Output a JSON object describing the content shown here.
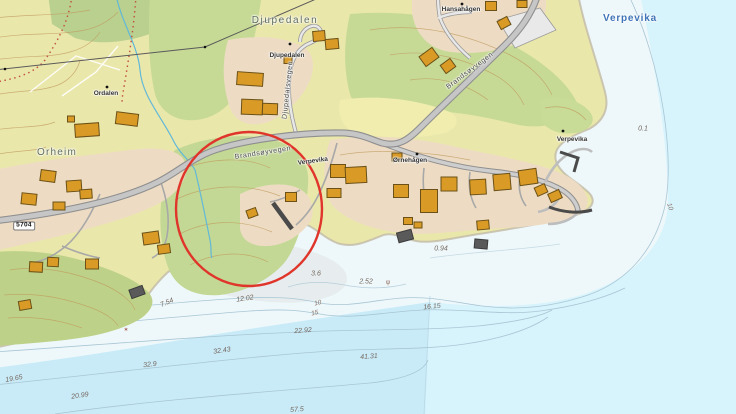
{
  "map": {
    "description": "Topographic coastal map with nautical depth soundings and a red circle annotation",
    "place_labels": [
      {
        "text": "Djupedalen"
      },
      {
        "text": "Djupedalen"
      },
      {
        "text": "Hansahågen"
      },
      {
        "text": "Verpevika"
      },
      {
        "text": "Ordalen"
      },
      {
        "text": "Orheim"
      },
      {
        "text": "Verpevika"
      },
      {
        "text": "Ørnehågen"
      },
      {
        "text": "Verpevika"
      }
    ],
    "road_labels": [
      {
        "text": "Brandsøyvegen"
      },
      {
        "text": "Brandsøyvegen"
      },
      {
        "text": "Djupedalsvegen"
      }
    ],
    "road_number": "5704",
    "soundings": [
      {
        "value": "0.1"
      },
      {
        "value": "0.94"
      },
      {
        "value": "3.6"
      },
      {
        "value": "2.52"
      },
      {
        "value": "12.02"
      },
      {
        "value": "16.15"
      },
      {
        "value": "22.92"
      },
      {
        "value": "32.43"
      },
      {
        "value": "32.9"
      },
      {
        "value": "41.31"
      },
      {
        "value": "7.54"
      },
      {
        "value": "19.65"
      },
      {
        "value": "20.99"
      },
      {
        "value": "57.5"
      }
    ],
    "depth_contour_labels": [
      {
        "value": "10"
      },
      {
        "value": "15"
      },
      {
        "value": "10"
      }
    ],
    "symbols": [
      {
        "name": "kelp-symbol",
        "glyph": "ψ"
      },
      {
        "name": "rock-awash-symbol",
        "glyph": "✶"
      }
    ],
    "annotation": {
      "shape": "ellipse",
      "purpose": "highlight area",
      "color": "#e0352b"
    }
  },
  "colors": {
    "sea": "#d7f3fc",
    "sea_deep": "#c9ebf8",
    "sea_shallow": "#eef8fb",
    "land_open": "#eae7ab",
    "vegetation": "#c6da96",
    "residential": "#eddcc3",
    "building": "#d99a26",
    "building_outline": "#6b5117",
    "road_fill": "#c6c6c6",
    "road_casing": "#8f8f8f",
    "land_contour": "#c09a5f",
    "depth_contour": "#a9c6d4",
    "stream": "#62b8d8",
    "annotation_red": "#e0352b",
    "sea_label_blue": "#3f74b8"
  }
}
